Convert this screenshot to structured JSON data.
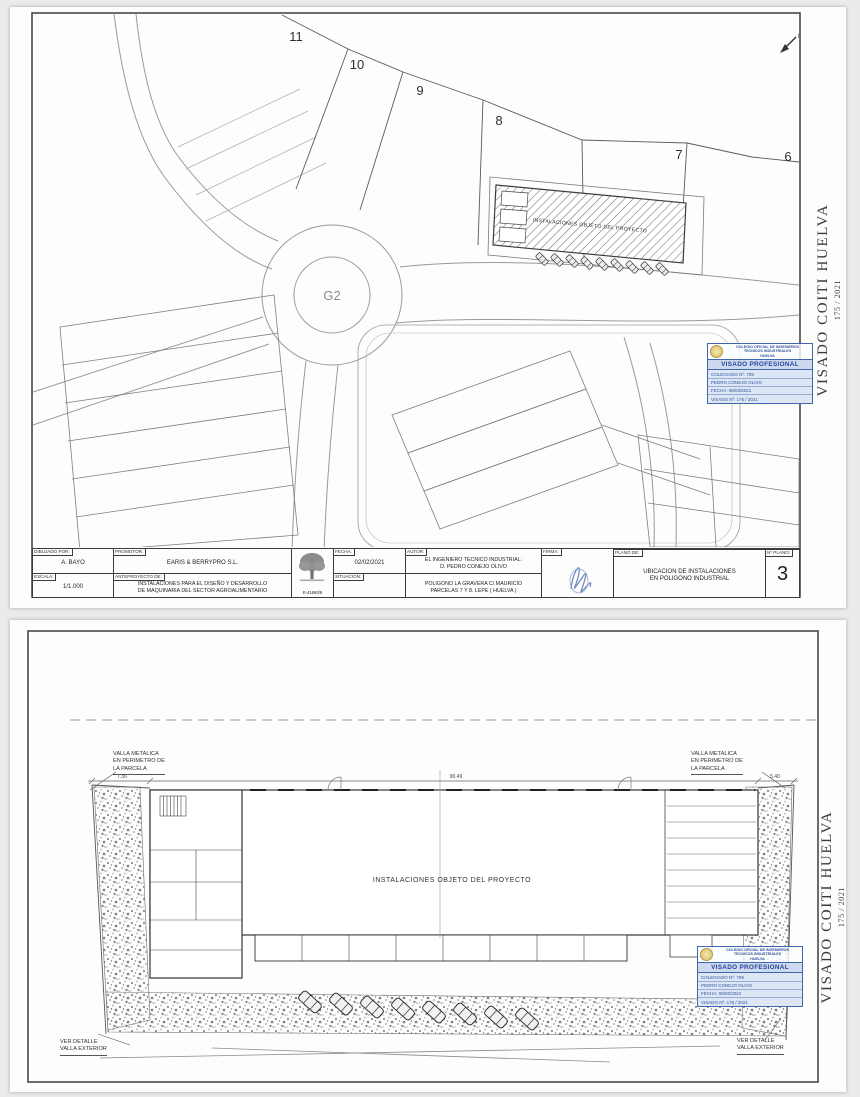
{
  "colors": {
    "background": "#ebebe9",
    "paper": "#fdfdfc",
    "line": "#555555",
    "stamp_blue": "#4066ad"
  },
  "visado_margin": {
    "text": "VISADO COITI HUELVA",
    "number": "175 / 2021"
  },
  "stamp": {
    "org_line1": "COLEGIO OFICIAL DE INGENIEROS",
    "org_line2": "TECNICOS INDUSTRIALES",
    "org_line3": "HUELVA",
    "title": "VISADO PROFESIONAL",
    "rows": [
      "COLEGIADO Nº: 709",
      "PEDRO CONEJO OLIVO",
      "FECHA: 08/03/2021",
      "VISADO Nº: 175 / 2021"
    ]
  },
  "sheet1": {
    "plan": {
      "parcels": [
        "11",
        "10",
        "9",
        "8",
        "7",
        "6"
      ],
      "roundabout": "G2",
      "north_label": "N",
      "building_label": "INSTALACIONES OBJETO DEL PROYECTO"
    },
    "titleblock": {
      "dibujado_label": "DIBUJADO POR:",
      "dibujado_value": "A. BAYO",
      "promotor_label": "PROMOTOR:",
      "promotor_value": "EARIS & BERRYPRO S.L.",
      "escala_label": "ESCALA:",
      "escala_value": "1/1.000",
      "anteproyecto_label": "ANTEPROYECTO DE:",
      "anteproyecto_value": "INSTALACIONES PARA EL DISEÑO Y DESARROLLO\nDE MAQUINARIA DEL SECTOR AGROALIMENTARIO",
      "logo_code": "E-41660/6",
      "fecha_label": "FECHA:",
      "fecha_value": "02/02/2021",
      "situacion_label": "SITUACION:",
      "situacion_value": "POLIGONO LA GRAVERA C/ MAURICIO\nPARCELAS 7 Y 8. LEPE ( HUELVA )",
      "autor_label": "AUTOR:",
      "autor_value": "EL INGENIERO TECNICO INDUSTRIAL:\nD. PEDRO CONEJO OLIVO",
      "firma_label": "FIRMA:",
      "plano_de_label": "PLANO DE:",
      "plano_de_value": "UBICACION DE INSTALACIONES\nEN POLIGONO INDUSTRIAL",
      "num_plano_label": "Nº PLANO:",
      "num_plano_value": "3"
    }
  },
  "sheet2": {
    "labels": {
      "fence_left": "VALLA METALICA\nEN PERIMETRO DE\nLA PARCELA",
      "fence_right": "VALLA METALICA\nEN PERIMETRO DE\nLA PARCELA",
      "building": "INSTALACIONES OBJETO DEL PROYECTO",
      "detail_left": "VER DETALLE\nVALLA EXTERIOR",
      "detail_right": "VER DETALLE\nVALLA EXTERIOR",
      "dim_width": "90.49",
      "dim_left": "7.36",
      "dim_right": "5.40"
    }
  }
}
